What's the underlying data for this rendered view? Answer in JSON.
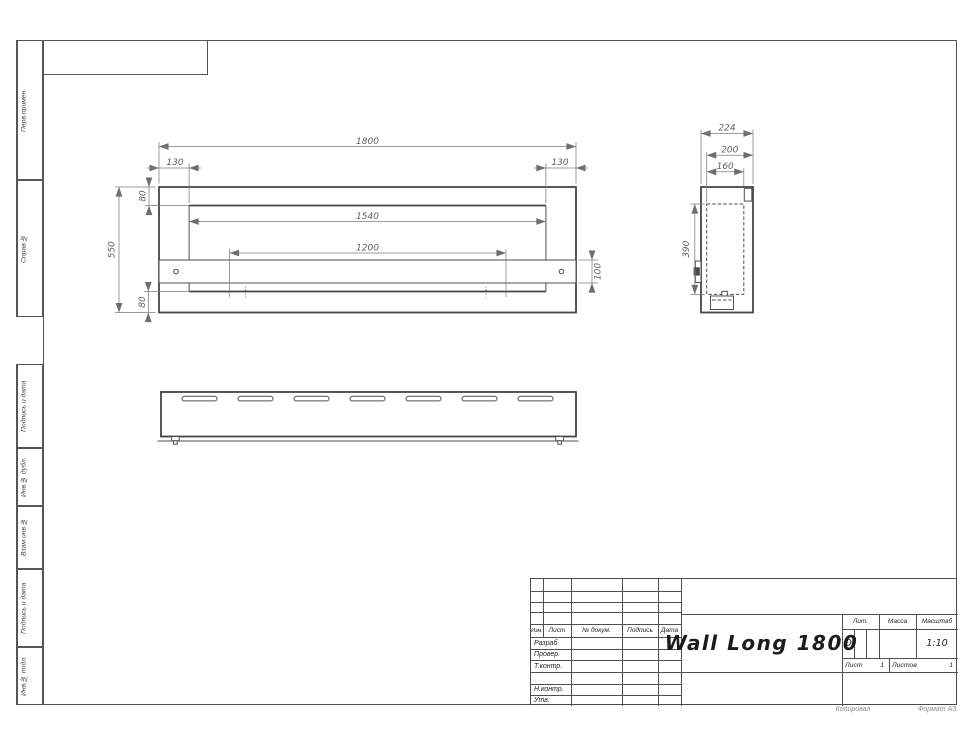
{
  "palette": {
    "line": "#4a4a4a",
    "dim_text": "#5f5f5f"
  },
  "frame_notes": {
    "copy": "Копировал",
    "format": "Формат А3"
  },
  "sidebar_stamps": [
    {
      "label": "Перв.примен."
    },
    {
      "label": "Справ.№"
    },
    {
      "label": "Подпись и дата"
    },
    {
      "label": "Инв.№ дубл."
    },
    {
      "label": "Взам.инв.№"
    },
    {
      "label": "Подпись и дата"
    },
    {
      "label": "Инв.№ подл."
    }
  ],
  "title_block": {
    "revision_header": {
      "izm": "Изм.",
      "list": "Лист",
      "doc": "№ докум.",
      "sign": "Подпись",
      "date": "Дата"
    },
    "role_rows": [
      {
        "label": "Разраб."
      },
      {
        "label": "Провер."
      },
      {
        "label": "Т.контр."
      },
      {
        "label": ""
      },
      {
        "label": "Н.контр."
      },
      {
        "label": "Утв."
      }
    ],
    "designation": "Wall Long 1800",
    "litera": {
      "label": "Лит.",
      "value": "О"
    },
    "mass": {
      "label": "Масса",
      "value": ""
    },
    "scale": {
      "label": "Масштаб",
      "value": "1:10"
    },
    "sheet": {
      "label": "Лист",
      "value": "1"
    },
    "sheets": {
      "label": "Листов",
      "value": "1"
    }
  },
  "drawing": {
    "front_view": {
      "dims": {
        "total_width": "1800",
        "left_inset": "130",
        "right_inset": "130",
        "top_flange": "80",
        "opening_width": "1540",
        "mount_spacing": "1200",
        "total_height": "550",
        "bracket_height": "100",
        "bottom_flange": "80"
      }
    },
    "side_view": {
      "dims": {
        "total_depth": "224",
        "body_depth": "200",
        "firebox_depth": "160",
        "firebox_height": "390"
      }
    },
    "bottom_view": {
      "slot_count": 7
    }
  }
}
